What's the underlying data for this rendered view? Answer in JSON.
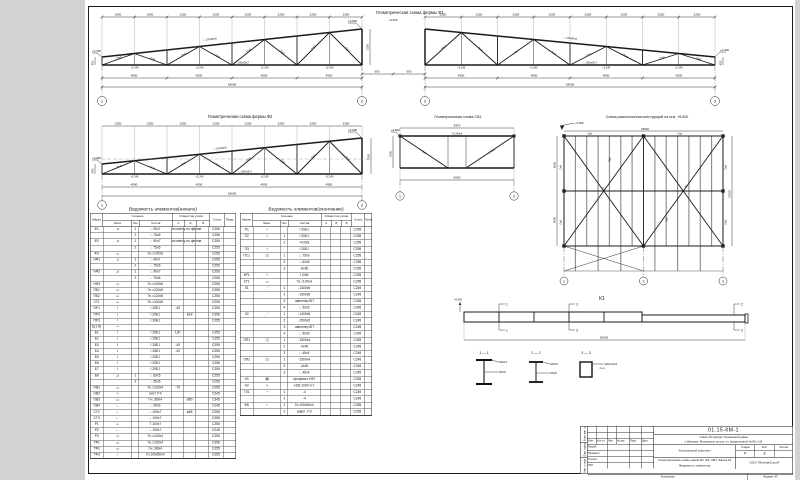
{
  "titles": {
    "f1": "Геометрическая схема фермы Ф1",
    "f2": "Геометрическая схема фермы Ф2",
    "sv": "Геометрическая схема СВ1",
    "plan": "Схема расположения конструкций на отм. +6.500",
    "t1": "Ведомость элементов(начало)",
    "t2": "Ведомость элементов(окончание)"
  },
  "f1": {
    "panel": "2250",
    "panel_b": "4500",
    "total": "18000",
    "h_left": "450",
    "h_right": "3150",
    "ridge": "600",
    "elev_low": "+3.300",
    "elev_high": "+6.600",
    "node": "+2.240",
    "ax1": "1",
    "ax2": "2",
    "ax3": "3",
    "m_top": "∟125х80х8",
    "m_bot": "∟100х63х7",
    "m_diag": "∟75х6"
  },
  "f2": {
    "panel": "2250",
    "panel_b": "4500",
    "total": "18000",
    "h_left": "450",
    "h_right": "3150",
    "elev_low": "+3.300",
    "elev_high": "+6.600",
    "node": "+2.240",
    "ax1": "1",
    "ax2": "2",
    "m_top": "∟125х80х8",
    "m_bot": "∟100х63х7",
    "m_diag": "∟75х6"
  },
  "sv": {
    "dim_top": "5970",
    "dim_bot": "6000",
    "dim_side": "1500",
    "elev": "+6.600",
    "chord": "Гн.□80х4",
    "diag": "∟75х6",
    "ax1": "1",
    "ax2": "2"
  },
  "plan": {
    "elev": "+6.500",
    "dim_v1": "6000",
    "dim_v2": "6000",
    "dim_total": "18000",
    "dim_width": "12000",
    "tie": "См1",
    "brace": "Р1",
    "purlin": "Пр1",
    "ax": [
      "1",
      "2",
      "3"
    ]
  },
  "k1": {
    "label": "К1",
    "elev": "+6.500",
    "total": "18000",
    "f1": "1",
    "f2": "2",
    "f3": "3",
    "s11": "1 — 1",
    "s22": "2 — 2",
    "s33": "3 — 3",
    "s11a": "200х12",
    "s11b": "320х8",
    "s22a": "200х10",
    "s22b": "240х8",
    "s33a": "Гн.□100х100х4",
    "s33b": "2 шт."
  },
  "tables": {
    "headers": {
      "mark": "Марка",
      "sec": "Сечение",
      "sketch": "Эскиз",
      "pos": "Поз.",
      "comp": "Состав",
      "holes": "Отверстия узлов",
      "a": "А",
      "b": "Б",
      "v": "В",
      "steel": "Сталь",
      "note": "Прим."
    },
    "rows1": [
      {
        "m": "Ф1",
        "sk": "⊿",
        "p": "1",
        "c": "∟90х7",
        "a": "по месту по ферме",
        "st": "С255"
      },
      {
        "m": "",
        "sk": "",
        "p": "2",
        "c": "∟75х6",
        "st": "С255"
      },
      {
        "m": "Ф2",
        "sk": "⊿",
        "p": "1",
        "c": "∟90х7",
        "a": "по месту по ферме",
        "st": "С255"
      },
      {
        "m": "",
        "sk": "",
        "p": "2",
        "c": "∟75х6",
        "st": "С255"
      },
      {
        "m": "Ф3",
        "sk": "▭",
        "p": "",
        "c": "Гн.□100х5",
        "st": "С255"
      },
      {
        "m": "НФ1",
        "sk": "⊿",
        "p": "1",
        "c": "∟90х7",
        "st": "С255"
      },
      {
        "m": "",
        "sk": "",
        "p": "2",
        "c": "∟75х6",
        "st": "С255"
      },
      {
        "m": "НФ2",
        "sk": "⊿",
        "p": "1",
        "c": "∟90х7",
        "st": "С255"
      },
      {
        "m": "",
        "sk": "",
        "p": "2",
        "c": "∟75х6",
        "st": "С255"
      },
      {
        "m": "НФ3",
        "sk": "▭",
        "p": "",
        "c": "Гн.□100х5",
        "st": "С255"
      },
      {
        "m": "ПБ1",
        "sk": "▭",
        "p": "",
        "c": "Гн.□120х5",
        "st": "С255"
      },
      {
        "m": "ПБ2",
        "sk": "▭",
        "p": "",
        "c": "Гн.□120х5",
        "st": "С255"
      },
      {
        "m": "СТ1",
        "sk": "▭",
        "p": "",
        "c": "Гн.□100х5",
        "st": "С255"
      },
      {
        "m": "ПР1",
        "sk": "Ι",
        "p": "",
        "c": "Ι 20Б1",
        "a": "-40",
        "st": "С255"
      },
      {
        "m": "ПР2",
        "sk": "Ι",
        "p": "",
        "c": "Ι 20Б1",
        "b": "ø18",
        "st": "С255"
      },
      {
        "m": "ПР3",
        "sk": "Ι",
        "p": "",
        "c": "Ι 20Б1",
        "st": "С255"
      },
      {
        "m": "Б(1-8)",
        "sk": "—",
        "p": "",
        "c": "",
        "st": ""
      },
      {
        "m": "Б1",
        "sk": "Ι",
        "p": "",
        "c": "Ι 25Б1",
        "a": "120",
        "st": "С255"
      },
      {
        "m": "Б2",
        "sk": "Ι",
        "p": "",
        "c": "Ι 25Б1",
        "st": "С255"
      },
      {
        "m": "Б3",
        "sk": "Ι",
        "p": "",
        "c": "Ι 25Б1",
        "a": "-40",
        "st": "С255"
      },
      {
        "m": "Б4",
        "sk": "Ι",
        "p": "",
        "c": "Ι 25Б1",
        "a": "-40",
        "st": "С255"
      },
      {
        "m": "Б5",
        "sk": "Ι",
        "p": "",
        "c": "Ι 20Б1",
        "st": "С255"
      },
      {
        "m": "Б6",
        "sk": "Ι",
        "p": "",
        "c": "Ι 20Б1",
        "st": "С255"
      },
      {
        "m": "Б7",
        "sk": "Ι",
        "p": "",
        "c": "Ι 20Б1",
        "st": "С255"
      },
      {
        "m": "Б8",
        "sk": "⊿",
        "p": "1",
        "c": "∟63х5",
        "st": "С255"
      },
      {
        "m": "",
        "sk": "",
        "p": "2",
        "c": "∟50х5",
        "st": "С255"
      },
      {
        "m": "ОВ1",
        "sk": "▭",
        "p": "",
        "c": "Гн.□100х4",
        "a": "-70",
        "st": "С255"
      },
      {
        "m": "ОВ2",
        "sk": "∿",
        "p": "",
        "c": "лист t=4",
        "st": "С245"
      },
      {
        "m": "ОВ3",
        "sk": "▭",
        "p": "",
        "c": "Гн.□80х4",
        "b": "ø50",
        "st": "С345"
      },
      {
        "m": "ОВ4",
        "sk": "∟",
        "p": "",
        "c": "∟90х6",
        "st": "С245"
      },
      {
        "m": "СТ2",
        "sk": "∟",
        "p": "",
        "c": "∟100х7",
        "b": "ø65",
        "st": "С255"
      },
      {
        "m": "СТ3",
        "sk": "∟",
        "p": "",
        "c": "∟100х7",
        "st": "С255"
      },
      {
        "m": "Р1",
        "sk": "⊥",
        "p": "",
        "c": "Т 100х7",
        "st": "С255"
      },
      {
        "m": "Р2",
        "sk": "∟",
        "p": "",
        "c": "∟100х7",
        "st": "С245"
      },
      {
        "m": "Р3",
        "sk": "▭",
        "p": "",
        "c": "Гн.□100х4",
        "st": "С255"
      },
      {
        "m": "ТФ1",
        "sk": "▭",
        "p": "",
        "c": "Гн.□100х4",
        "st": "С255"
      },
      {
        "m": "ТФ2",
        "sk": "▭",
        "p": "",
        "c": "Гн.□80х4",
        "st": "С255"
      },
      {
        "m": "ТФ3",
        "sk": "⌐",
        "p": "",
        "c": "Гн.100х50х4",
        "st": "С255"
      }
    ],
    "rows2": [
      {
        "m": "П1",
        "sk": "Ι",
        "p": "",
        "c": "Ι 20Б1",
        "st": "С255"
      },
      {
        "m": "П2",
        "sk": "Ι",
        "p": "1",
        "c": "Ι 20Б1",
        "st": "С255"
      },
      {
        "m": "",
        "sk": "",
        "p": "2",
        "c": "-410х8",
        "st": "С255"
      },
      {
        "m": "П3",
        "sk": "Ι",
        "p": "",
        "c": "Ι 20Б1",
        "st": "С255"
      },
      {
        "m": "ПС1",
        "sk": "◫",
        "p": "1",
        "c": "∟75х6",
        "st": "С255"
      },
      {
        "m": "",
        "sk": "",
        "p": "2",
        "c": "∟63х5",
        "st": "С255"
      },
      {
        "m": "",
        "sk": "",
        "p": "3",
        "c": "-6х60",
        "st": "С255"
      },
      {
        "m": "КР1",
        "sk": "Ι",
        "p": "",
        "c": "Ι 24М",
        "st": "С255"
      },
      {
        "m": "СТ1",
        "sk": "▭",
        "p": "",
        "c": "Гн.□100х4",
        "st": "С255"
      },
      {
        "m": "Л1",
        "sk": "⋰",
        "p": "1",
        "c": "-1400х5",
        "st": "С245"
      },
      {
        "m": "",
        "sk": "",
        "p": "2",
        "c": "-1500х5",
        "st": "С245"
      },
      {
        "m": "",
        "sk": "",
        "p": "3",
        "c": "швеллер 8П",
        "st": "С245"
      },
      {
        "m": "",
        "sk": "",
        "p": "4",
        "c": "∟50х5",
        "st": "С245"
      },
      {
        "m": "Л2",
        "sk": "⋰",
        "p": "1",
        "c": "-1400х5",
        "st": "С245"
      },
      {
        "m": "",
        "sk": "",
        "p": "2",
        "c": "-1500х5",
        "st": "С245"
      },
      {
        "m": "",
        "sk": "",
        "p": "3",
        "c": "швеллер 8П",
        "st": "С245"
      },
      {
        "m": "",
        "sk": "",
        "p": "4",
        "c": "∟50х5",
        "st": "С245"
      },
      {
        "m": "ОП1",
        "sk": "◫",
        "p": "1",
        "c": "-1500х4",
        "st": "С245"
      },
      {
        "m": "",
        "sk": "",
        "p": "2",
        "c": "-4х40",
        "st": "С245"
      },
      {
        "m": "",
        "sk": "",
        "p": "3",
        "c": "∟45х4",
        "st": "С245"
      },
      {
        "m": "ОП2",
        "sk": "◫",
        "p": "1",
        "c": "-1500х4",
        "st": "С245"
      },
      {
        "m": "",
        "sk": "",
        "p": "2",
        "c": "-4х40",
        "st": "С245"
      },
      {
        "m": "",
        "sk": "",
        "p": "3",
        "c": "∟45х4",
        "st": "С245"
      },
      {
        "m": "Н1",
        "sk": "▤",
        "p": "",
        "c": "профлист Н57",
        "st": "С245"
      },
      {
        "m": "Н2",
        "sk": "∿",
        "p": "",
        "c": "Н35-1000-0,7",
        "st": "С245"
      },
      {
        "m": "ТЛ1",
        "sk": "⌐",
        "p": "1",
        "c": "-4",
        "st": "С245"
      },
      {
        "m": "",
        "sk": "",
        "p": "2",
        "c": "-4",
        "st": "С245"
      },
      {
        "m": "ФБ",
        "sk": "⌐",
        "p": "1",
        "c": "Гн.100х50х4",
        "st": "С255"
      },
      {
        "m": "",
        "sk": "",
        "p": "2",
        "c": "рифл. t=3",
        "st": "С255"
      }
    ]
  },
  "stamp": {
    "doc": "01.15-КМ-1",
    "addr1": "г.Санкт-Петербург, Пушкинский район",
    "addr2": "п.Шушары, Московское шоссе, уч. (кадастровый № 86 к.10)",
    "set": "Контрольный комплект",
    "stage_h": "Стадия",
    "sheet_h": "Лист",
    "sheets_h": "Листов",
    "stage": "Р",
    "sheet": "8",
    "sheets": "",
    "content1": "Геометрические схемы ферм Ф1, Ф2, СВ1. Балка К1",
    "content2": "Ведомость элементов",
    "org": "ООО \"МонтажСтрой\"",
    "copied": "Копировал",
    "format": "Формат А3",
    "hdr": [
      "Изм.",
      "Кол.уч",
      "Лист",
      "№ док.",
      "Подп.",
      "Дата"
    ],
    "roles": [
      "Разраб.",
      "Проверил",
      "Н.контр.",
      "ГИП"
    ],
    "side": [
      "Взам. инв. №",
      "Подп. и дата",
      "Инв. № подл."
    ]
  }
}
